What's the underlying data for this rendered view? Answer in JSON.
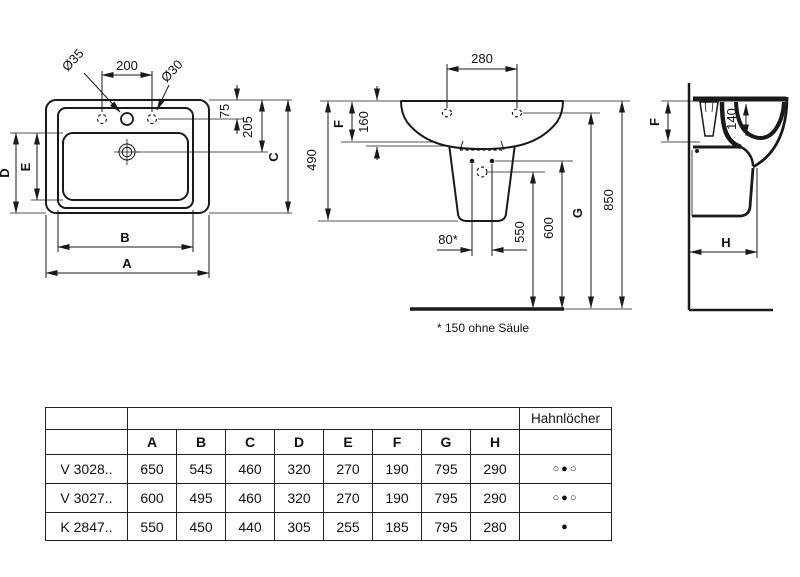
{
  "views": {
    "top": {
      "dia35": "Ø35",
      "dim200": "200",
      "dia30": "Ø30",
      "dim75": "75",
      "dim205": "205",
      "dimC": "C",
      "dimD": "D",
      "dimE": "E",
      "dimB": "B",
      "dimA": "A"
    },
    "front": {
      "dim280": "280",
      "dimF": "F",
      "dim160": "160",
      "dim490": "490",
      "dim80": "80*",
      "dim550": "550",
      "dim600": "600",
      "dimG": "G",
      "dim850": "850"
    },
    "side": {
      "dimF": "F",
      "dim140": "140",
      "dimH": "H"
    },
    "note": "* 150 ohne Säule"
  },
  "table": {
    "hahnloecher_header": "Hahnlöcher",
    "columns": [
      "A",
      "B",
      "C",
      "D",
      "E",
      "F",
      "G",
      "H"
    ],
    "rows": [
      {
        "label": "V 3028..",
        "values": [
          "650",
          "545",
          "460",
          "320",
          "270",
          "190",
          "795",
          "290"
        ],
        "holes": "○●○"
      },
      {
        "label": "V 3027..",
        "values": [
          "600",
          "495",
          "460",
          "320",
          "270",
          "190",
          "795",
          "290"
        ],
        "holes": "○●○"
      },
      {
        "label": "K 2847..",
        "values": [
          "550",
          "450",
          "440",
          "305",
          "255",
          "185",
          "795",
          "280"
        ],
        "holes": "●"
      }
    ]
  },
  "colors": {
    "ink": "#1a1a1a",
    "background": "#ffffff"
  }
}
